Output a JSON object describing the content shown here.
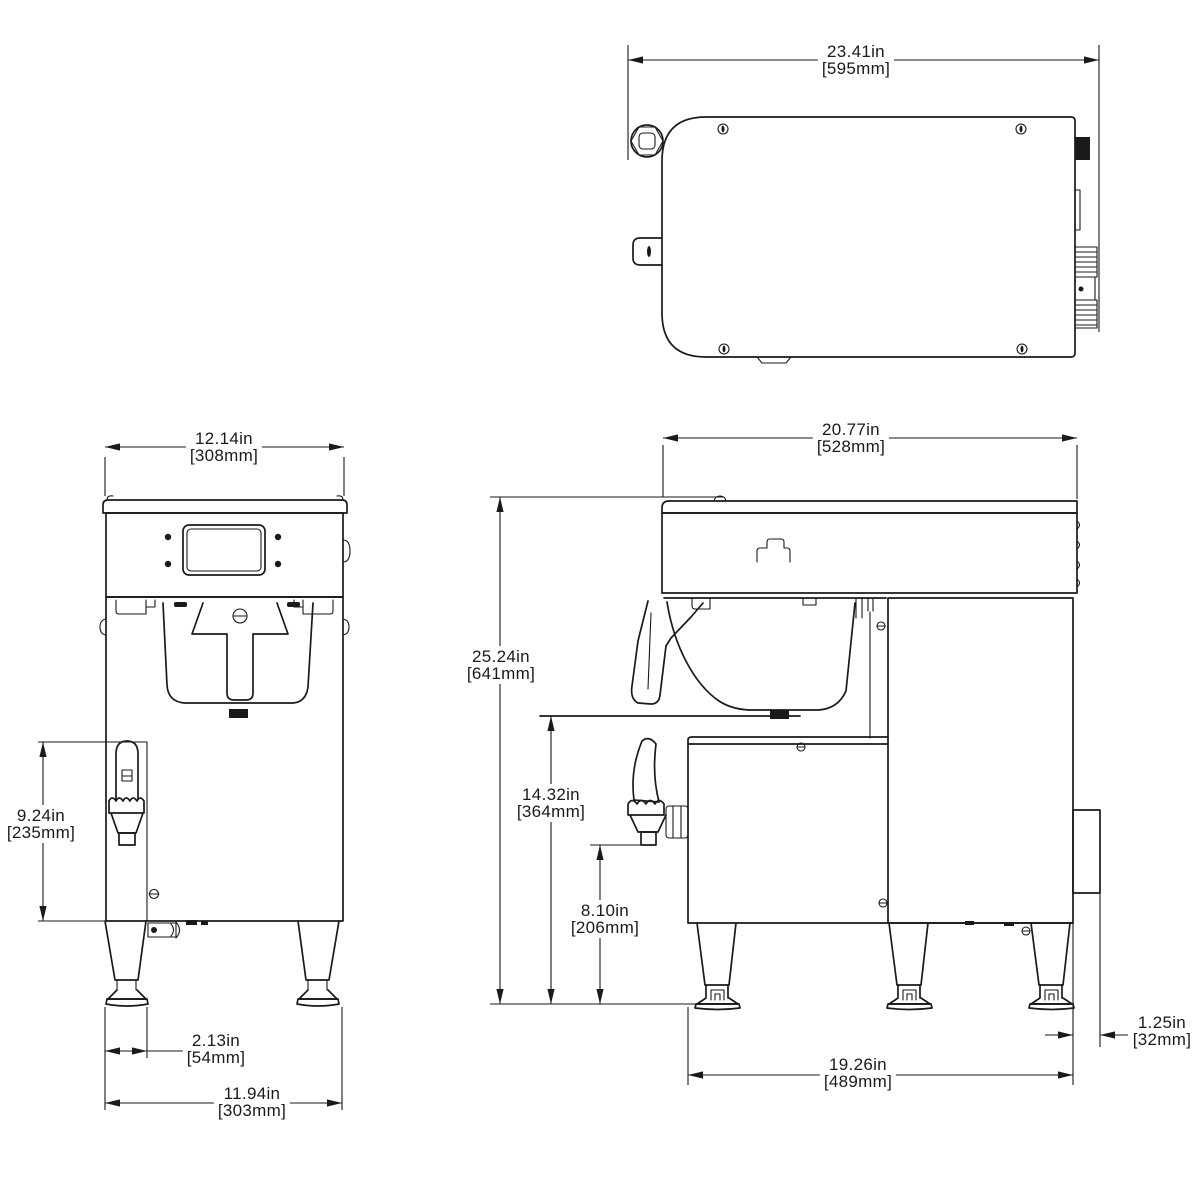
{
  "drawing": {
    "type": "orthographic-dimension-drawing",
    "subject": "coffee brewer with hot water faucet",
    "views": [
      "top-view",
      "front-view",
      "side-view"
    ]
  },
  "colors": {
    "line": "#1a1a1a",
    "background": "#ffffff"
  },
  "dimensions": {
    "top_depth": {
      "in": "23.41in",
      "mm": "[595mm]"
    },
    "front_width": {
      "in": "12.14in",
      "mm": "[308mm]"
    },
    "faucet_height": {
      "in": "9.24in",
      "mm": "[235mm]"
    },
    "faucet_offset": {
      "in": "2.13in",
      "mm": "[54mm]"
    },
    "front_base_width": {
      "in": "11.94in",
      "mm": "[303mm]"
    },
    "side_depth": {
      "in": "20.77in",
      "mm": "[528mm]"
    },
    "overall_height": {
      "in": "25.24in",
      "mm": "[641mm]"
    },
    "server_clearance": {
      "in": "14.32in",
      "mm": "[364mm]"
    },
    "faucet_clearance": {
      "in": "8.10in",
      "mm": "[206mm]"
    },
    "base_depth": {
      "in": "19.26in",
      "mm": "[489mm]"
    },
    "rear_projection": {
      "in": "1.25in",
      "mm": "[32mm]"
    }
  }
}
